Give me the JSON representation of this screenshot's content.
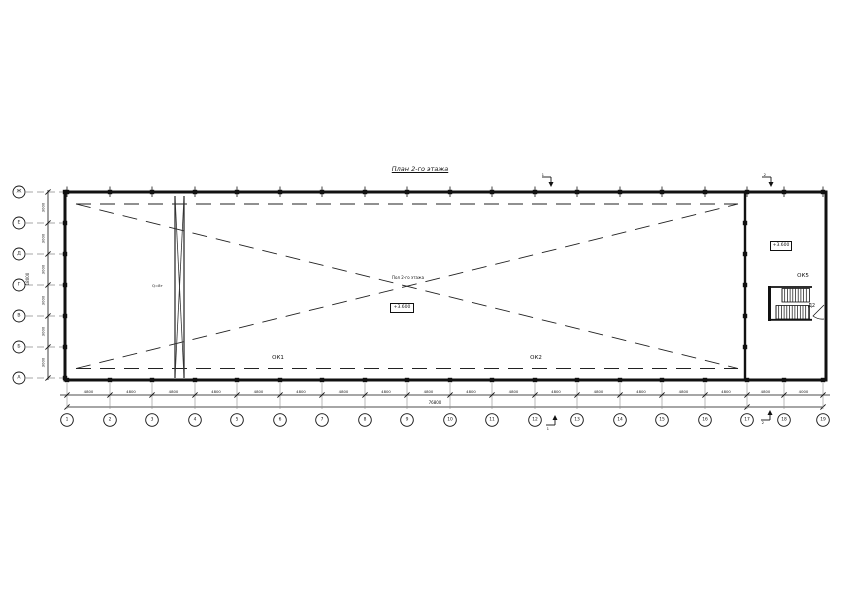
{
  "title": "План 2-го этажа",
  "colors": {
    "line": "#111111",
    "gray": "#8a8a8a",
    "background": "#ffffff"
  },
  "grid": {
    "bottom_axes": [
      "1",
      "2",
      "3",
      "4",
      "5",
      "6",
      "7",
      "8",
      "9",
      "10",
      "11",
      "12",
      "13",
      "14",
      "15",
      "16",
      "17",
      "18",
      "19"
    ],
    "left_axes": [
      "Ж",
      "Е",
      "Д",
      "Г",
      "В",
      "Б",
      "А"
    ],
    "bottom_bay_dims": [
      "4800",
      "4800",
      "4800",
      "4800",
      "4800",
      "4800",
      "4800",
      "4800",
      "4800",
      "4800",
      "4800",
      "4800",
      "4800",
      "4800",
      "4800",
      "4800",
      "4800",
      "4000"
    ],
    "bottom_total": "76800",
    "left_bay_dims": [
      "3000",
      "3000",
      "3000",
      "3000",
      "3000",
      "3000"
    ],
    "left_total": "18000"
  },
  "labels": {
    "window1": "ОК1",
    "window2": "ОК2",
    "window5": "ОК5",
    "door": "Д2",
    "brace": "Q=8т",
    "center_note": "Пол 2-го этажа",
    "center_elevation": "+3.600",
    "stair_elevation": "+3.600"
  },
  "section_marks": {
    "left": "1",
    "right": "2"
  }
}
